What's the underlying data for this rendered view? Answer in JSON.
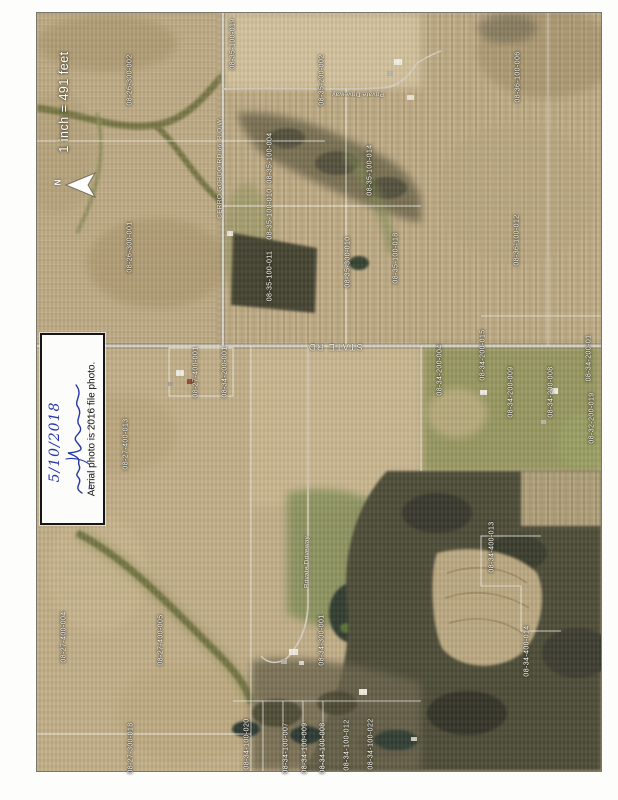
{
  "map": {
    "scale_label": "1 inch = 491 feet",
    "north_label": "N"
  },
  "note": {
    "printed_text": "Aerial photo is 2016 file photo.",
    "handwritten_date": "5/10/2018"
  },
  "colors": {
    "label_white": "#ffffff",
    "ink_blue": "#2538a8",
    "field_tan": "#c3ae85",
    "woods_dark": "#4b4b34",
    "road_light": "#d9d5c8"
  },
  "road_labels": [
    {
      "text": "STATE RD",
      "x": 335,
      "y": 347,
      "rot": 180,
      "size": 9,
      "ls": 1.5
    },
    {
      "text": "Private Driveway",
      "x": 358,
      "y": 94,
      "rot": 180,
      "size": 6.5,
      "ls": 0.2
    },
    {
      "text": "Private Driveway",
      "x": 307,
      "y": 562,
      "rot": -90,
      "size": 6.5,
      "ls": 0.2
    },
    {
      "text": "CERRO GORDO RD 66' R.O.W.",
      "x": 220,
      "y": 168,
      "rot": -90,
      "size": 6.5,
      "ls": 0.3
    }
  ],
  "parcel_labels": [
    {
      "text": "08-26-300-002",
      "x": 130,
      "y": 80
    },
    {
      "text": "08-26-300-001",
      "x": 130,
      "y": 247
    },
    {
      "text": "08-35-100-019",
      "x": 233,
      "y": 44
    },
    {
      "text": "08-35-200-002",
      "x": 322,
      "y": 80
    },
    {
      "text": "08-36-100-006",
      "x": 518,
      "y": 77
    },
    {
      "text": "08-36-100-012",
      "x": 517,
      "y": 240
    },
    {
      "text": "08-35-100-004",
      "x": 270,
      "y": 158
    },
    {
      "text": "08-35-100-010",
      "x": 270,
      "y": 214
    },
    {
      "text": "08-35-100-011",
      "x": 270,
      "y": 276
    },
    {
      "text": "08-35-100-014",
      "x": 370,
      "y": 170
    },
    {
      "text": "08-35-300-010",
      "x": 348,
      "y": 262
    },
    {
      "text": "08-35-100-018",
      "x": 396,
      "y": 258
    },
    {
      "text": "08-27-400-001",
      "x": 196,
      "y": 372
    },
    {
      "text": "08-34-200-001",
      "x": 225,
      "y": 372
    },
    {
      "text": "08-34-200-004",
      "x": 440,
      "y": 370
    },
    {
      "text": "08-34-200-015",
      "x": 483,
      "y": 355
    },
    {
      "text": "08-34-200-009",
      "x": 511,
      "y": 392
    },
    {
      "text": "08-34-200-008",
      "x": 551,
      "y": 392
    },
    {
      "text": "08-34-200-01",
      "x": 589,
      "y": 358
    },
    {
      "text": "08-32-200-019",
      "x": 592,
      "y": 418
    },
    {
      "text": "08-27-400-013",
      "x": 126,
      "y": 444
    },
    {
      "text": "08-27-400-004",
      "x": 64,
      "y": 637
    },
    {
      "text": "08-27-400-005",
      "x": 161,
      "y": 640
    },
    {
      "text": "08-27-300-018",
      "x": 131,
      "y": 748
    },
    {
      "text": "08-34-100-020",
      "x": 247,
      "y": 744
    },
    {
      "text": "08-34-100-007",
      "x": 286,
      "y": 748
    },
    {
      "text": "08-34-100-009",
      "x": 305,
      "y": 748
    },
    {
      "text": "08-34-100-008",
      "x": 323,
      "y": 748
    },
    {
      "text": "08-34-100-012",
      "x": 347,
      "y": 745
    },
    {
      "text": "08-34-100-022",
      "x": 371,
      "y": 744
    },
    {
      "text": "08-34-300-001",
      "x": 322,
      "y": 640
    },
    {
      "text": "08-34-400-013",
      "x": 492,
      "y": 547
    },
    {
      "text": "08-34-400-014",
      "x": 527,
      "y": 651
    }
  ]
}
